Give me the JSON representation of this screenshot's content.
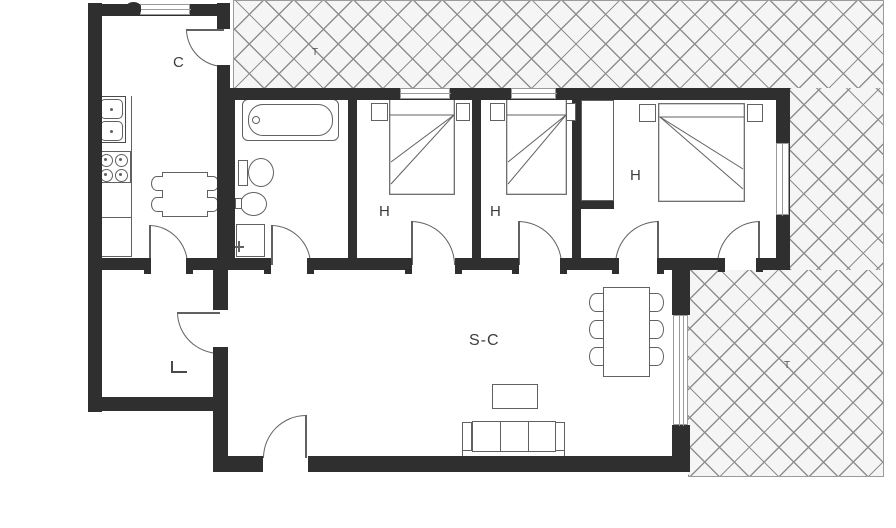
{
  "document": {
    "type": "architectural floor plan"
  },
  "labels": {
    "kitchen": "C",
    "bedroom1": "H",
    "bedroom2": "H",
    "bedroom3": "H",
    "living_dining": "S-C",
    "terrace_top": "T",
    "terrace_right": "T"
  },
  "rooms": [
    {
      "id": "kitchen",
      "label": "C"
    },
    {
      "id": "bathroom",
      "label": ""
    },
    {
      "id": "bedroom-1",
      "label": "H"
    },
    {
      "id": "bedroom-2",
      "label": "H"
    },
    {
      "id": "bedroom-3",
      "label": "H"
    },
    {
      "id": "living-dining-room",
      "label": "S-C"
    },
    {
      "id": "entry-hall",
      "label": ""
    },
    {
      "id": "terrace-top",
      "label": "T"
    },
    {
      "id": "terrace-right",
      "label": "T"
    }
  ],
  "colors": {
    "wall": "#2f2f2f",
    "furn": "#616161",
    "hatch": "#8f8f8f",
    "hatchbg": "#f5f5f5",
    "bg": "#ffffff",
    "label": "#3c3c3c",
    "win": "#9a9a9a"
  }
}
